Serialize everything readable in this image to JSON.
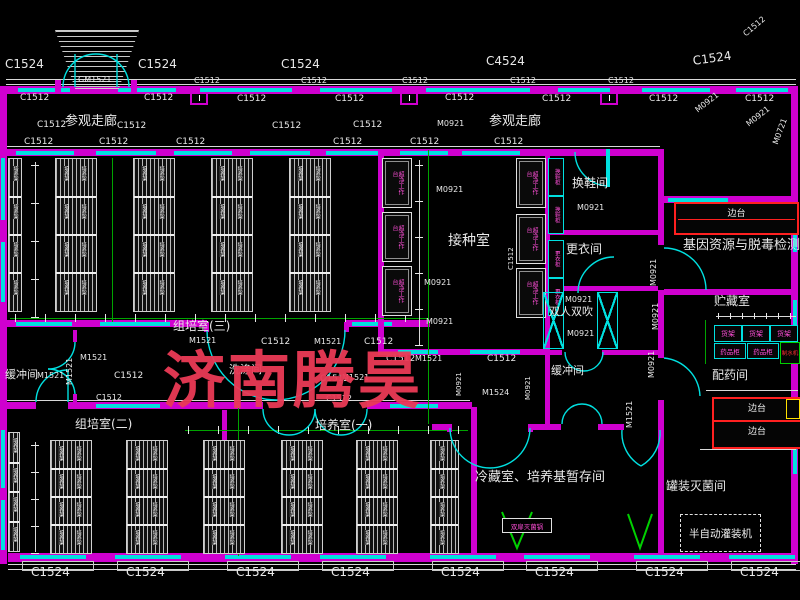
{
  "watermark": {
    "text": "济南腾昊",
    "color": "#ea3a56"
  },
  "colors": {
    "wall": "#cf00cf",
    "window": "#00e0e0",
    "dimension": "#00a400",
    "text": "#e8e8e8",
    "bench_red": "#ff2020",
    "equip_magenta": "#ff4fd8",
    "sterilizer_green": "#00d000",
    "sink_yellow": "#ffe000"
  },
  "labels": [
    {
      "t": "C1524",
      "x": 5,
      "y": 58,
      "s": 12
    },
    {
      "t": "C1524",
      "x": 138,
      "y": 58,
      "s": 12
    },
    {
      "t": "C1524",
      "x": 281,
      "y": 58,
      "s": 12
    },
    {
      "t": "C4524",
      "x": 486,
      "y": 55,
      "s": 12
    },
    {
      "t": "C1524",
      "x": 692,
      "y": 55,
      "s": 12,
      "r": -8
    },
    {
      "t": "C1512",
      "x": 742,
      "y": 32,
      "s": 8,
      "r": -40
    },
    {
      "t": "GM1521",
      "x": 78,
      "y": 76,
      "s": 8
    },
    {
      "t": "C1512",
      "x": 194,
      "y": 77,
      "s": 8
    },
    {
      "t": "C1512",
      "x": 301,
      "y": 77,
      "s": 8
    },
    {
      "t": "C1512",
      "x": 402,
      "y": 77,
      "s": 8
    },
    {
      "t": "C1512",
      "x": 510,
      "y": 77,
      "s": 8
    },
    {
      "t": "C1512",
      "x": 608,
      "y": 77,
      "s": 8
    },
    {
      "t": "C1512",
      "x": 20,
      "y": 94,
      "s": 9
    },
    {
      "t": "C1512",
      "x": 144,
      "y": 94,
      "s": 9
    },
    {
      "t": "C1512",
      "x": 237,
      "y": 95,
      "s": 9
    },
    {
      "t": "C1512",
      "x": 335,
      "y": 95,
      "s": 9
    },
    {
      "t": "C1512",
      "x": 445,
      "y": 94,
      "s": 9
    },
    {
      "t": "C1512",
      "x": 542,
      "y": 95,
      "s": 9
    },
    {
      "t": "C1512",
      "x": 649,
      "y": 95,
      "s": 9
    },
    {
      "t": "C1512",
      "x": 745,
      "y": 95,
      "s": 9
    },
    {
      "t": "C1512",
      "x": 37,
      "y": 121,
      "s": 9
    },
    {
      "t": "参观走廊",
      "x": 65,
      "y": 115,
      "s": 13
    },
    {
      "t": "C1512",
      "x": 117,
      "y": 122,
      "s": 9
    },
    {
      "t": "C1512",
      "x": 272,
      "y": 122,
      "s": 9
    },
    {
      "t": "C1512",
      "x": 353,
      "y": 121,
      "s": 9
    },
    {
      "t": "M0921",
      "x": 437,
      "y": 120,
      "s": 8
    },
    {
      "t": "参观走廊",
      "x": 489,
      "y": 115,
      "s": 13
    },
    {
      "t": "M0921",
      "x": 694,
      "y": 108,
      "s": 8,
      "r": -38
    },
    {
      "t": "M0921",
      "x": 745,
      "y": 122,
      "s": 8,
      "r": -38
    },
    {
      "t": "M0721",
      "x": 772,
      "y": 143,
      "s": 8,
      "r": -70
    },
    {
      "t": "C1512",
      "x": 24,
      "y": 138,
      "s": 9
    },
    {
      "t": "C1512",
      "x": 99,
      "y": 138,
      "s": 9
    },
    {
      "t": "C1512",
      "x": 176,
      "y": 138,
      "s": 9
    },
    {
      "t": "C1512",
      "x": 333,
      "y": 138,
      "s": 9
    },
    {
      "t": "C1512",
      "x": 410,
      "y": 138,
      "s": 9
    },
    {
      "t": "C1512",
      "x": 494,
      "y": 138,
      "s": 9
    },
    {
      "t": "M0921",
      "x": 436,
      "y": 186,
      "s": 8
    },
    {
      "t": "接种室",
      "x": 448,
      "y": 234,
      "s": 14
    },
    {
      "t": "C1512",
      "x": 508,
      "y": 270,
      "s": 7,
      "r": -90
    },
    {
      "t": "M0921",
      "x": 424,
      "y": 279,
      "s": 8
    },
    {
      "t": "M0921",
      "x": 426,
      "y": 318,
      "s": 8
    },
    {
      "t": "换鞋间",
      "x": 572,
      "y": 177,
      "s": 12
    },
    {
      "t": "M0921",
      "x": 577,
      "y": 204,
      "s": 8
    },
    {
      "t": "更衣间",
      "x": 566,
      "y": 243,
      "s": 12
    },
    {
      "t": "M0921",
      "x": 565,
      "y": 296,
      "s": 8
    },
    {
      "t": "双人双吹",
      "x": 549,
      "y": 306,
      "s": 11
    },
    {
      "t": "M0921",
      "x": 567,
      "y": 330,
      "s": 8
    },
    {
      "t": "缓冲间",
      "x": 551,
      "y": 365,
      "s": 11
    },
    {
      "t": "M1521",
      "x": 626,
      "y": 428,
      "s": 8,
      "r": -90
    },
    {
      "t": "M0921",
      "x": 650,
      "y": 286,
      "s": 8,
      "r": -90
    },
    {
      "t": "M0921",
      "x": 652,
      "y": 330,
      "s": 8,
      "r": -90
    },
    {
      "t": "M0921",
      "x": 648,
      "y": 378,
      "s": 8,
      "r": -90
    },
    {
      "t": "基因资源与脱毒检测室",
      "x": 683,
      "y": 239,
      "s": 13
    },
    {
      "t": "贮藏室",
      "x": 714,
      "y": 295,
      "s": 12
    },
    {
      "t": "配药间",
      "x": 712,
      "y": 369,
      "s": 12
    },
    {
      "t": "罐装灭菌间",
      "x": 666,
      "y": 480,
      "s": 12
    },
    {
      "t": "组培室(三)",
      "x": 173,
      "y": 320,
      "s": 12
    },
    {
      "t": "M1521",
      "x": 189,
      "y": 337,
      "s": 8
    },
    {
      "t": "缓冲间",
      "x": 5,
      "y": 369,
      "s": 11
    },
    {
      "t": "M1521",
      "x": 37,
      "y": 372,
      "s": 8
    },
    {
      "t": "M1521",
      "x": 66,
      "y": 385,
      "s": 8,
      "r": -90
    },
    {
      "t": "M1521",
      "x": 80,
      "y": 354,
      "s": 8
    },
    {
      "t": "C1512",
      "x": 114,
      "y": 372,
      "s": 9
    },
    {
      "t": "C1512",
      "x": 261,
      "y": 338,
      "s": 9
    },
    {
      "t": "M1521",
      "x": 314,
      "y": 338,
      "s": 8
    },
    {
      "t": "C1512",
      "x": 364,
      "y": 338,
      "s": 9
    },
    {
      "t": "洗涤间",
      "x": 229,
      "y": 364,
      "s": 11
    },
    {
      "t": "C1512",
      "x": 320,
      "y": 375,
      "s": 9
    },
    {
      "t": "M1521",
      "x": 342,
      "y": 374,
      "s": 8
    },
    {
      "t": "C1512",
      "x": 326,
      "y": 395,
      "s": 8
    },
    {
      "t": "C1512",
      "x": 386,
      "y": 355,
      "s": 9
    },
    {
      "t": "M1521",
      "x": 415,
      "y": 355,
      "s": 8
    },
    {
      "t": "C1512",
      "x": 487,
      "y": 355,
      "s": 9
    },
    {
      "t": "M1524",
      "x": 482,
      "y": 389,
      "s": 8
    },
    {
      "t": "M0921",
      "x": 525,
      "y": 400,
      "s": 7,
      "r": -90
    },
    {
      "t": "M0921",
      "x": 456,
      "y": 396,
      "s": 7,
      "r": -90
    },
    {
      "t": "组培室(二)",
      "x": 75,
      "y": 418,
      "s": 12
    },
    {
      "t": "C1512",
      "x": 96,
      "y": 394,
      "s": 8
    },
    {
      "t": "培养室(一)",
      "x": 315,
      "y": 419,
      "s": 12
    },
    {
      "t": "冷藏室、培养基暂存间",
      "x": 475,
      "y": 471,
      "s": 13
    },
    {
      "t": "C1524",
      "x": 31,
      "y": 566,
      "s": 12
    },
    {
      "t": "C1524",
      "x": 126,
      "y": 566,
      "s": 12
    },
    {
      "t": "C1524",
      "x": 236,
      "y": 566,
      "s": 12
    },
    {
      "t": "C1524",
      "x": 331,
      "y": 566,
      "s": 12
    },
    {
      "t": "C1524",
      "x": 441,
      "y": 566,
      "s": 12
    },
    {
      "t": "C1524",
      "x": 535,
      "y": 566,
      "s": 12
    },
    {
      "t": "C1524",
      "x": 645,
      "y": 566,
      "s": 12
    },
    {
      "t": "C1524",
      "x": 740,
      "y": 566,
      "s": 12
    }
  ],
  "equipment": {
    "rack_unit_label": "培养架",
    "bench_label": "超净工作台",
    "cabinets": [
      {
        "t": "换鞋柜"
      },
      {
        "t": "换鞋柜"
      },
      {
        "t": "更衣柜"
      },
      {
        "t": "更衣柜"
      }
    ],
    "shelves": [
      {
        "t": "货架"
      },
      {
        "t": "货架"
      },
      {
        "t": "货架"
      }
    ],
    "med_cabinets": [
      {
        "t": "药品柜"
      },
      {
        "t": "药品柜"
      }
    ],
    "water_machine": {
      "t": "制水机"
    },
    "side_benches": [
      {
        "t": "边台"
      },
      {
        "t": "边台"
      },
      {
        "t": "边台"
      }
    ],
    "sterilizer": {
      "t": "双扉灭菌锅"
    },
    "filler": {
      "t": "半自动灌装机"
    }
  }
}
